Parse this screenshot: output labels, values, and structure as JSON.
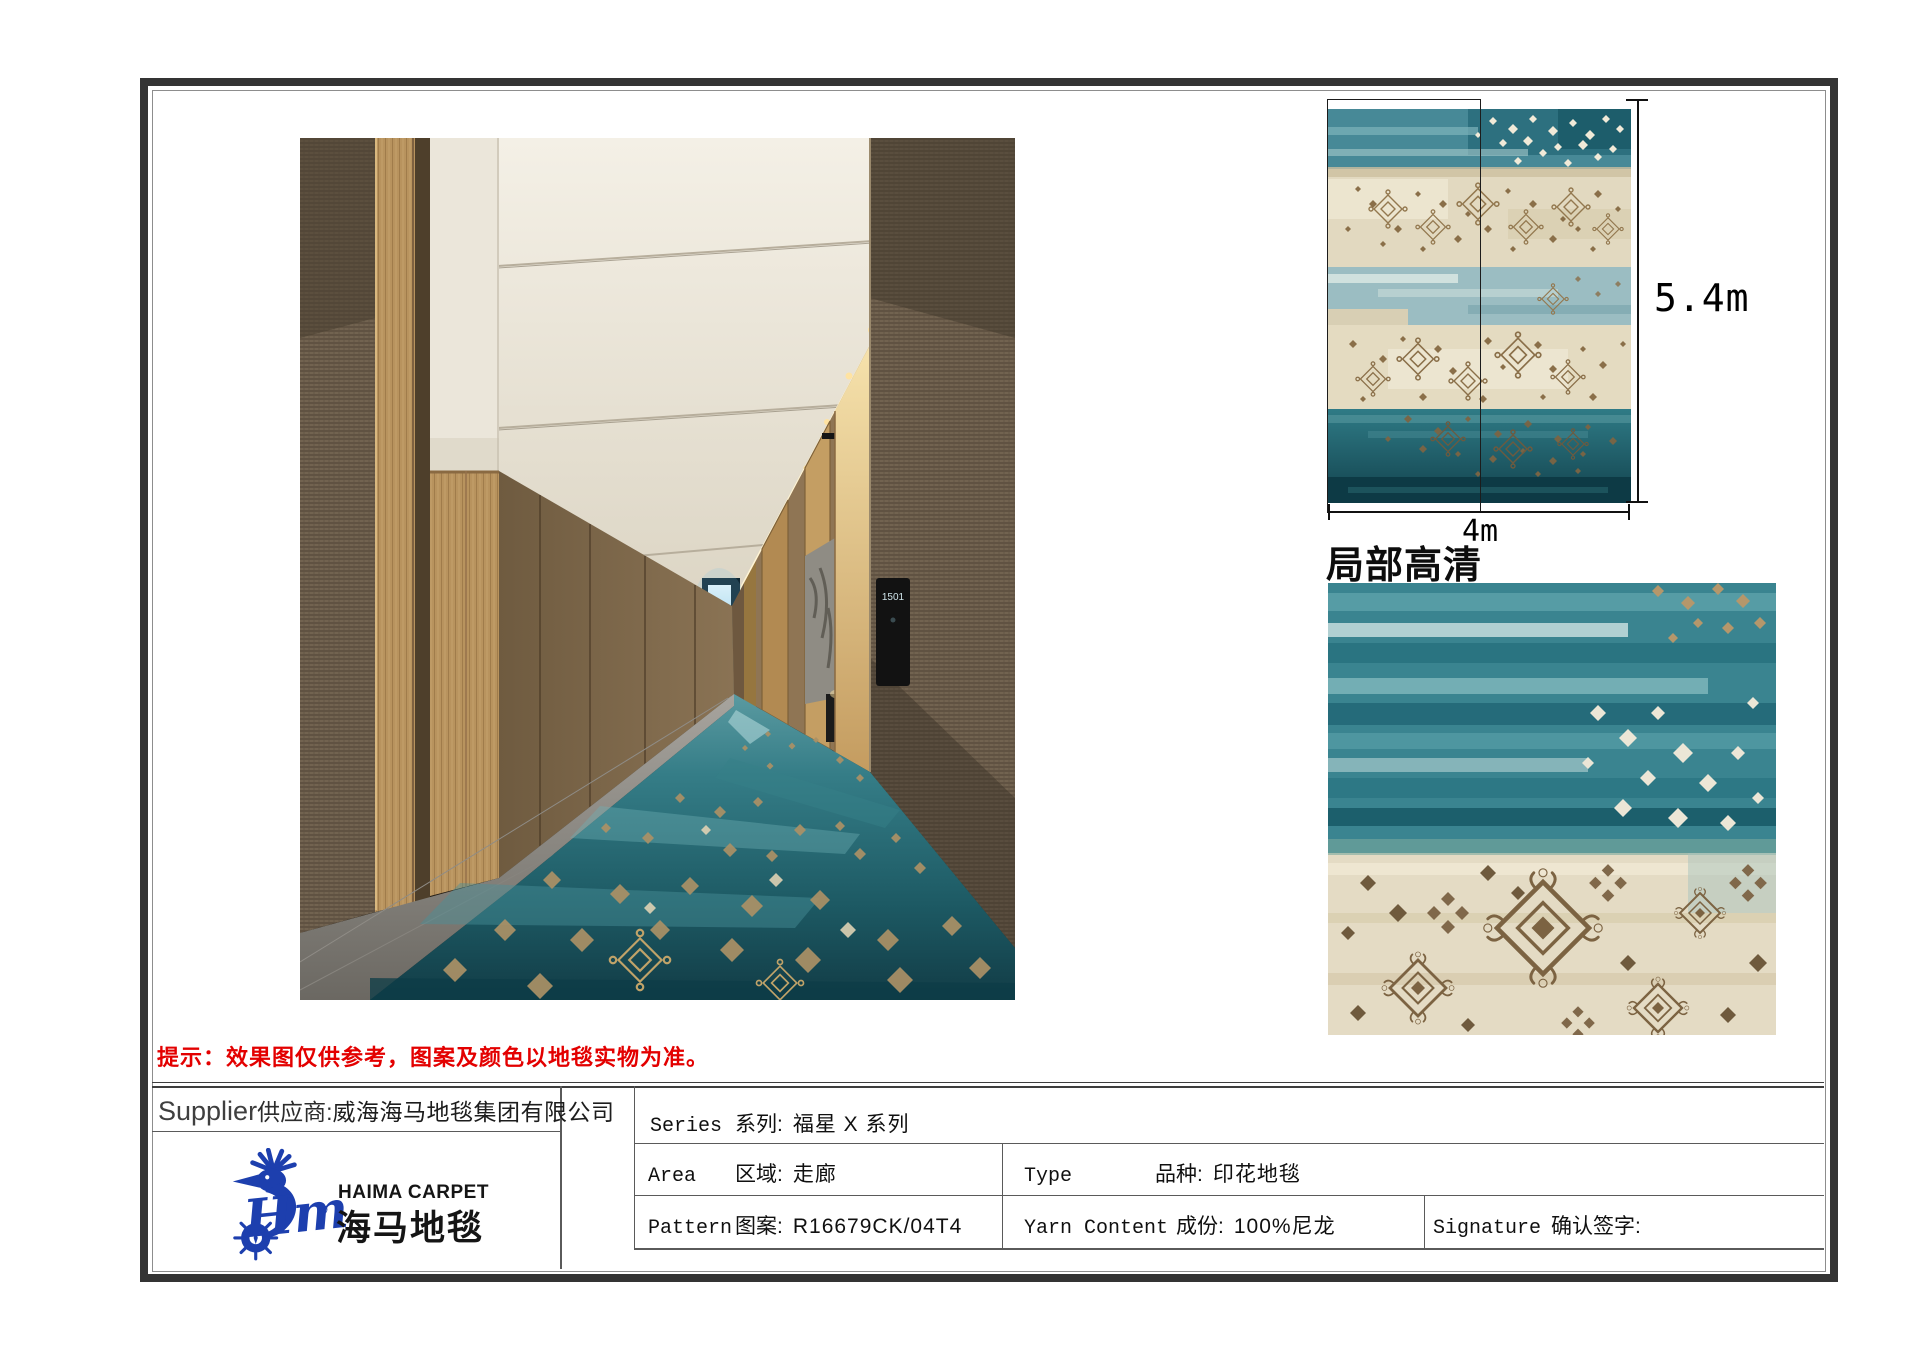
{
  "note": {
    "text": "提示：效果图仅供参考，图案及颜色以地毯实物为准。",
    "color": "#e30000"
  },
  "corridor": {
    "door_number": "1501"
  },
  "swatch": {
    "height_label": "5.4m",
    "width_label": "4m",
    "detail_label": "局部高清"
  },
  "supplier": {
    "en": "Supplier",
    "zh_label": "供应商:",
    "company": "威海海马地毯集团有限公司"
  },
  "logo": {
    "en": "HAIMA CARPET",
    "zh": "海马地毯",
    "reg": "®",
    "script": "Hm",
    "color": "#1d3fae"
  },
  "specs": {
    "series": {
      "en": "Series",
      "zh": "系列:",
      "value": "福星 X 系列"
    },
    "area": {
      "en": "Area",
      "zh": "区域:",
      "value": "走廊"
    },
    "type": {
      "en": "Type",
      "zh": "品种:",
      "value": "印花地毯"
    },
    "pattern": {
      "en": "Pattern",
      "zh": "图案:",
      "value": "R16679CK/04T4"
    },
    "yarn": {
      "en": "Yarn Content",
      "zh": "成份:",
      "value": "100%尼龙"
    },
    "signature": {
      "en": "Signature",
      "zh": "确认签字:",
      "value": ""
    }
  },
  "colors": {
    "note_red": "#e30000",
    "logo_blue": "#1d3fae",
    "carpet_teal": "#2a727c",
    "carpet_cream": "#e4dbc1",
    "motif_brown": "#8a6f49",
    "frame_dark": "#343434"
  }
}
